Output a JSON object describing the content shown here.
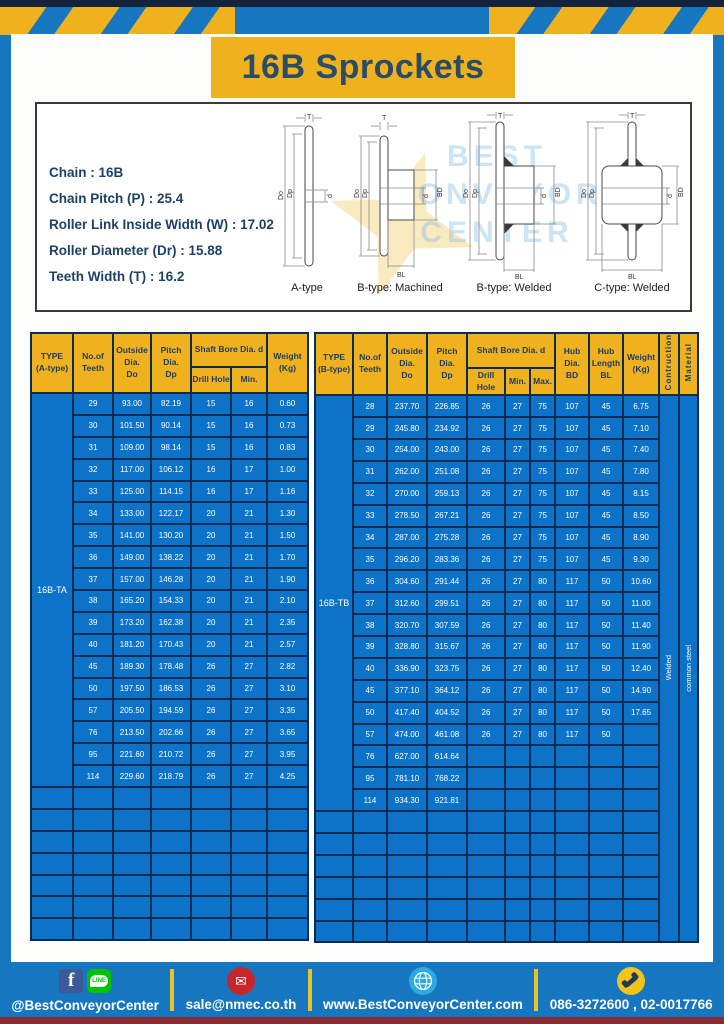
{
  "banner": {
    "title": "16B Sprockets"
  },
  "specs": {
    "lines": [
      "Chain  :  16B",
      "Chain Pitch (P)  :  25.4",
      "Roller Link Inside Width (W)  :  17.02",
      "Roller Diameter (Dr)  : 15.88",
      "Teeth Width (T)  :  16.2"
    ]
  },
  "diagrams": {
    "dims": {
      "T": "T",
      "Do": "Do",
      "Dp": "Dp",
      "d": "d",
      "BD": "BD",
      "BL": "BL"
    },
    "items": [
      {
        "caption": "A-type"
      },
      {
        "caption": "B-type: Machined"
      },
      {
        "caption": "B-type: Welded"
      },
      {
        "caption": "C-type: Welded"
      }
    ]
  },
  "watermark": {
    "lines": [
      "BEST",
      "CONVEYOR",
      "CENTER"
    ]
  },
  "tables": {
    "A": {
      "headers": {
        "type": "TYPE\n(A-type)",
        "teeth": "No.of\nTeeth",
        "outside": "Outside\nDia.\nDo",
        "pitch": "Pitch Dia.\nDp",
        "shaft_bore": "Shaft Bore Dia. d",
        "drill": "Drill Hole",
        "min": "Min.",
        "weight": "Weight\n(Kg)"
      },
      "type_label": "16B-TA",
      "rows": [
        [
          "29",
          "93.00",
          "82.19",
          "15",
          "16",
          "0.60"
        ],
        [
          "30",
          "101.50",
          "90.14",
          "15",
          "16",
          "0.73"
        ],
        [
          "31",
          "109.00",
          "98.14",
          "15",
          "16",
          "0.83"
        ],
        [
          "32",
          "117.00",
          "106.12",
          "16",
          "17",
          "1.00"
        ],
        [
          "33",
          "125.00",
          "114.15",
          "16",
          "17",
          "1.16"
        ],
        [
          "34",
          "133.00",
          "122.17",
          "20",
          "21",
          "1.30"
        ],
        [
          "35",
          "141.00",
          "130.20",
          "20",
          "21",
          "1.50"
        ],
        [
          "36",
          "149.00",
          "138.22",
          "20",
          "21",
          "1.70"
        ],
        [
          "37",
          "157.00",
          "146.28",
          "20",
          "21",
          "1.90"
        ],
        [
          "38",
          "165.20",
          "154.33",
          "20",
          "21",
          "2.10"
        ],
        [
          "39",
          "173.20",
          "162.38",
          "20",
          "21",
          "2.35"
        ],
        [
          "40",
          "181.20",
          "170.43",
          "20",
          "21",
          "2.57"
        ],
        [
          "45",
          "189.30",
          "178.48",
          "26",
          "27",
          "2.82"
        ],
        [
          "50",
          "197.50",
          "186.53",
          "26",
          "27",
          "3.10"
        ],
        [
          "57",
          "205.50",
          "194.59",
          "26",
          "27",
          "3.35"
        ],
        [
          "76",
          "213.50",
          "202.66",
          "26",
          "27",
          "3.65"
        ],
        [
          "95",
          "221.60",
          "210.72",
          "26",
          "27",
          "3.95"
        ],
        [
          "114",
          "229.60",
          "218.79",
          "26",
          "27",
          "4.25"
        ]
      ],
      "empty_rows": 7
    },
    "B": {
      "headers": {
        "type": "TYPE\n(B-type)",
        "teeth": "No.of\nTeeth",
        "outside": "Outside\nDia.\nDo",
        "pitch": "Pitch Dia.\nDp",
        "shaft_bore": "Shaft Bore Dia. d",
        "drill": "Drill Hole",
        "min": "Min.",
        "max": "Max.",
        "hub_dia": "Hub Dia.\nBD",
        "hub_len": "Hub\nLength\nBL",
        "weight": "Weight\n(Kg)",
        "construction": "Contruction",
        "material": "Material"
      },
      "type_label": "16B-TB",
      "construction_label": "Welded",
      "material_label": "common steel",
      "rows": [
        [
          "28",
          "237.70",
          "226.85",
          "26",
          "27",
          "75",
          "107",
          "45",
          "6.75"
        ],
        [
          "29",
          "245.80",
          "234.92",
          "26",
          "27",
          "75",
          "107",
          "45",
          "7.10"
        ],
        [
          "30",
          "254.00",
          "243.00",
          "26",
          "27",
          "75",
          "107",
          "45",
          "7.40"
        ],
        [
          "31",
          "262.00",
          "251.08",
          "26",
          "27",
          "75",
          "107",
          "45",
          "7.80"
        ],
        [
          "32",
          "270.00",
          "259.13",
          "26",
          "27",
          "75",
          "107",
          "45",
          "8.15"
        ],
        [
          "33",
          "278.50",
          "267.21",
          "26",
          "27",
          "75",
          "107",
          "45",
          "8.50"
        ],
        [
          "34",
          "287.00",
          "275.28",
          "26",
          "27",
          "75",
          "107",
          "45",
          "8.90"
        ],
        [
          "35",
          "296.20",
          "283.36",
          "26",
          "27",
          "75",
          "107",
          "45",
          "9.30"
        ],
        [
          "36",
          "304.60",
          "291.44",
          "26",
          "27",
          "80",
          "117",
          "50",
          "10.60"
        ],
        [
          "37",
          "312.60",
          "299.51",
          "26",
          "27",
          "80",
          "117",
          "50",
          "11.00"
        ],
        [
          "38",
          "320.70",
          "307.59",
          "26",
          "27",
          "80",
          "117",
          "50",
          "11.40"
        ],
        [
          "39",
          "328.80",
          "315.67",
          "26",
          "27",
          "80",
          "117",
          "50",
          "11.90"
        ],
        [
          "40",
          "336.90",
          "323.75",
          "26",
          "27",
          "80",
          "117",
          "50",
          "12.40"
        ],
        [
          "45",
          "377.10",
          "364.12",
          "26",
          "27",
          "80",
          "117",
          "50",
          "14.90"
        ],
        [
          "50",
          "417.40",
          "404.52",
          "26",
          "27",
          "80",
          "117",
          "50",
          "17.65"
        ],
        [
          "57",
          "474.00",
          "461.08",
          "26",
          "27",
          "80",
          "117",
          "50",
          ""
        ],
        [
          "76",
          "627.00",
          "614.64",
          "",
          "",
          "",
          "",
          "",
          ""
        ],
        [
          "95",
          "781.10",
          "768.22",
          "",
          "",
          "",
          "",
          "",
          ""
        ],
        [
          "114",
          "934.30",
          "921.81",
          "",
          "",
          "",
          "",
          "",
          ""
        ]
      ],
      "empty_rows": 6
    }
  },
  "footer": {
    "facebook_letter": "f",
    "line_badge": "LINE",
    "email_glyph": "✉",
    "items": [
      {
        "label": "@BestConveyorCenter"
      },
      {
        "label": "sale@nmec.co.th"
      },
      {
        "label": "www.BestConveyorCenter.com"
      },
      {
        "label": "086-3272600 , 02-0017766"
      }
    ]
  },
  "colors": {
    "page_blue": "#1677c0",
    "navy": "#14233c",
    "amber": "#efb21e",
    "table_blue": "#0c73c8",
    "table_border": "#0b2c52",
    "email_red": "#c9252c",
    "line_green": "#00c300",
    "globe_cyan": "#2aabe2",
    "phone_yellow": "#f2c318",
    "bottom_maroon": "#8b2b33"
  }
}
